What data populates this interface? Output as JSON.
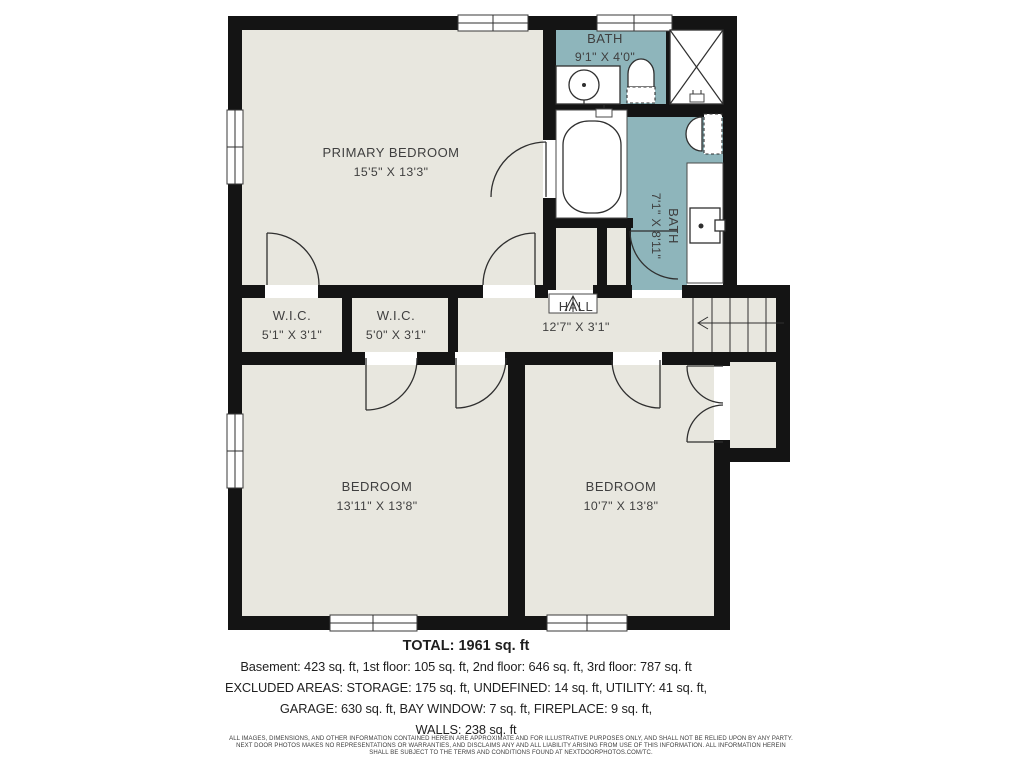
{
  "meta": {
    "background_color": "#FFFFFF",
    "wall_color": "#141414",
    "floor_color": "#E8E7DF",
    "bath_color": "#8EB5BB",
    "line_color": "#2F2F2F",
    "label_color": "#3F3F3F"
  },
  "rooms": [
    {
      "id": "primary-bedroom",
      "label": "PRIMARY BEDROOM",
      "dims": "15'5\" X 13'3\""
    },
    {
      "id": "bath-top",
      "label": "BATH",
      "dims": "9'1\" X 4'0\""
    },
    {
      "id": "bath-ensuite",
      "label": "BATH",
      "dims": "7'1\" X 8'11\""
    },
    {
      "id": "wic-1",
      "label": "W.I.C.",
      "dims": "5'1\" X 3'1\""
    },
    {
      "id": "wic-2",
      "label": "W.I.C.",
      "dims": "5'0\" X 3'1\""
    },
    {
      "id": "hall",
      "label": "HALL",
      "dims": "12'7\" X 3'1\""
    },
    {
      "id": "bedroom-left",
      "label": "BEDROOM",
      "dims": "13'11\" X 13'8\""
    },
    {
      "id": "bedroom-right",
      "label": "BEDROOM",
      "dims": "10'7\" X 13'8\""
    }
  ],
  "summary": {
    "total": "TOTAL: 1961 sq. ft",
    "line1": "Basement: 423 sq. ft, 1st floor: 105 sq. ft, 2nd floor: 646 sq. ft, 3rd floor: 787 sq. ft",
    "line2": "EXCLUDED AREAS: STORAGE: 175 sq. ft, UNDEFINED: 14 sq. ft, UTILITY: 41 sq. ft,",
    "line3": "GARAGE: 630 sq. ft, BAY WINDOW: 7 sq. ft, FIREPLACE: 9 sq. ft,",
    "line4": "WALLS: 238 sq. ft"
  },
  "disclaimer": {
    "line1": "ALL IMAGES, DIMENSIONS, AND OTHER INFORMATION CONTAINED HEREIN ARE APPROXIMATE AND FOR ILLUSTRATIVE PURPOSES ONLY, AND SHALL NOT BE RELIED UPON BY ANY PARTY.",
    "line2": "NEXT DOOR PHOTOS MAKES NO REPRESENTATIONS OR WARRANTIES, AND DISCLAIMS ANY AND ALL LIABILITY ARISING FROM USE OF THIS INFORMATION. ALL INFORMATION HEREIN",
    "line3": "SHALL BE SUBJECT TO THE TERMS AND CONDITIONS FOUND AT NEXTDOORPHOTOS.COM/TC."
  }
}
